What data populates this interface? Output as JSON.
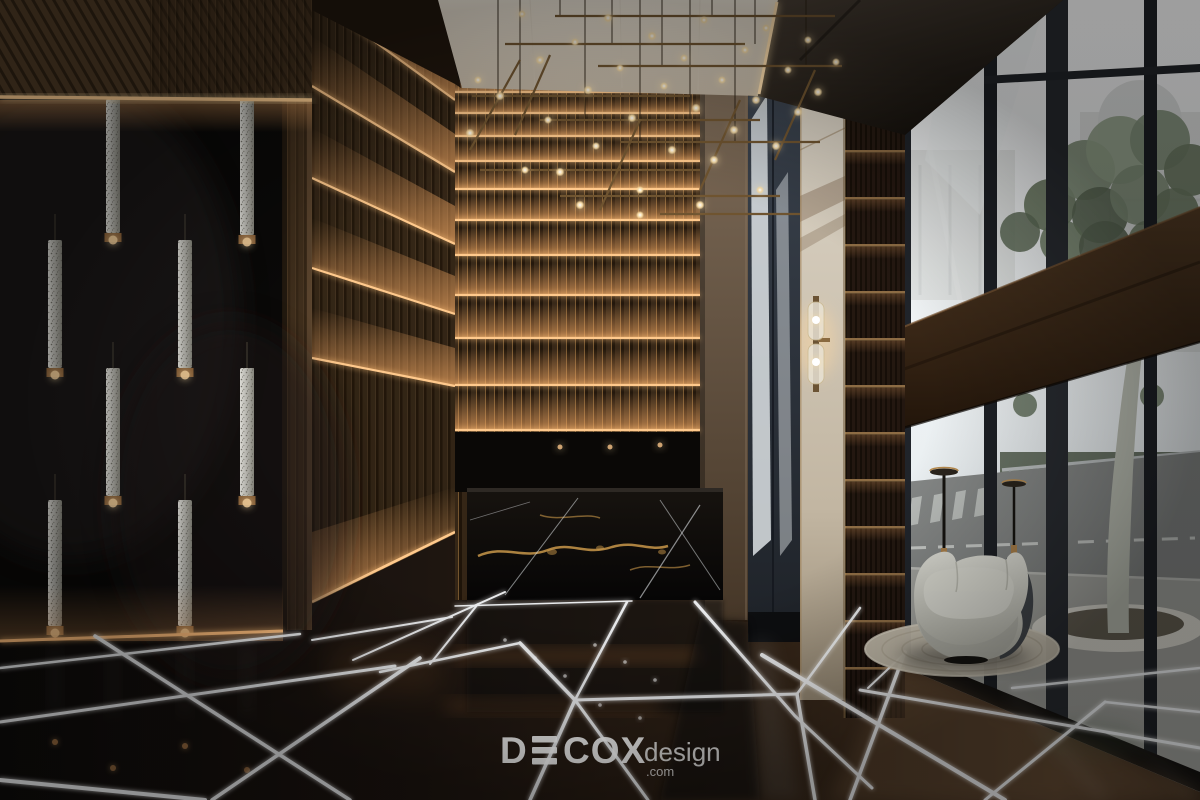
{
  "meta": {
    "title": "Luxury lobby interior 3D render",
    "type": "photorealistic-interior-render"
  },
  "watermark": {
    "brand_full": "DECOX",
    "brand_d": "D",
    "brand_rest": "COX",
    "suffix": "design",
    "domain": ".com",
    "color": "#ffffff"
  },
  "scene": {
    "description": "Double-height hotel lobby: glossy black wall with crystal tube pendants, fluted wood walls with horizontal LED cove bands, black-gold marble reception desk, dark marble floor with white LED inlay lines, cream stone panel with brass sconce, full-height glass facade with street view, tree in round planter, grey curved armchair on round rug, linear bulb chandelier",
    "elements": [
      {
        "name": "wood-slat-soffit"
      },
      {
        "name": "crystal-pendant-lights"
      },
      {
        "name": "black-glass-wall"
      },
      {
        "name": "fluted-wall-led-bands"
      },
      {
        "name": "ceiling-chandelier"
      },
      {
        "name": "reception-desk-black-marble"
      },
      {
        "name": "taupe-column"
      },
      {
        "name": "glass-partition"
      },
      {
        "name": "cream-marble-panel-with-sconce"
      },
      {
        "name": "bronze-slat-niche"
      },
      {
        "name": "glass-curtain-wall"
      },
      {
        "name": "street-view-tree-and-road"
      },
      {
        "name": "armchair-on-rug"
      },
      {
        "name": "floor-lamps"
      },
      {
        "name": "led-inlay-marble-floor"
      },
      {
        "name": "decox-watermark"
      }
    ]
  },
  "palette": {
    "amber_led": "#ffc27a",
    "white_led": "#ffffff",
    "wood_dark": "#3a2a19",
    "wood_light": "#6a5138",
    "cream_ceiling": "#e2d9cb",
    "black_marble": "#0c0b0a",
    "gold_vein": "#c9984a",
    "taupe_wall": "#75634f",
    "glass_sky": "#f2f5f6",
    "foliage_green": "#74856a",
    "chair_fabric": "#cbccc4",
    "rug": "#c6bfae",
    "brass": "#a97f4a",
    "floor_brown": "#241a12"
  }
}
